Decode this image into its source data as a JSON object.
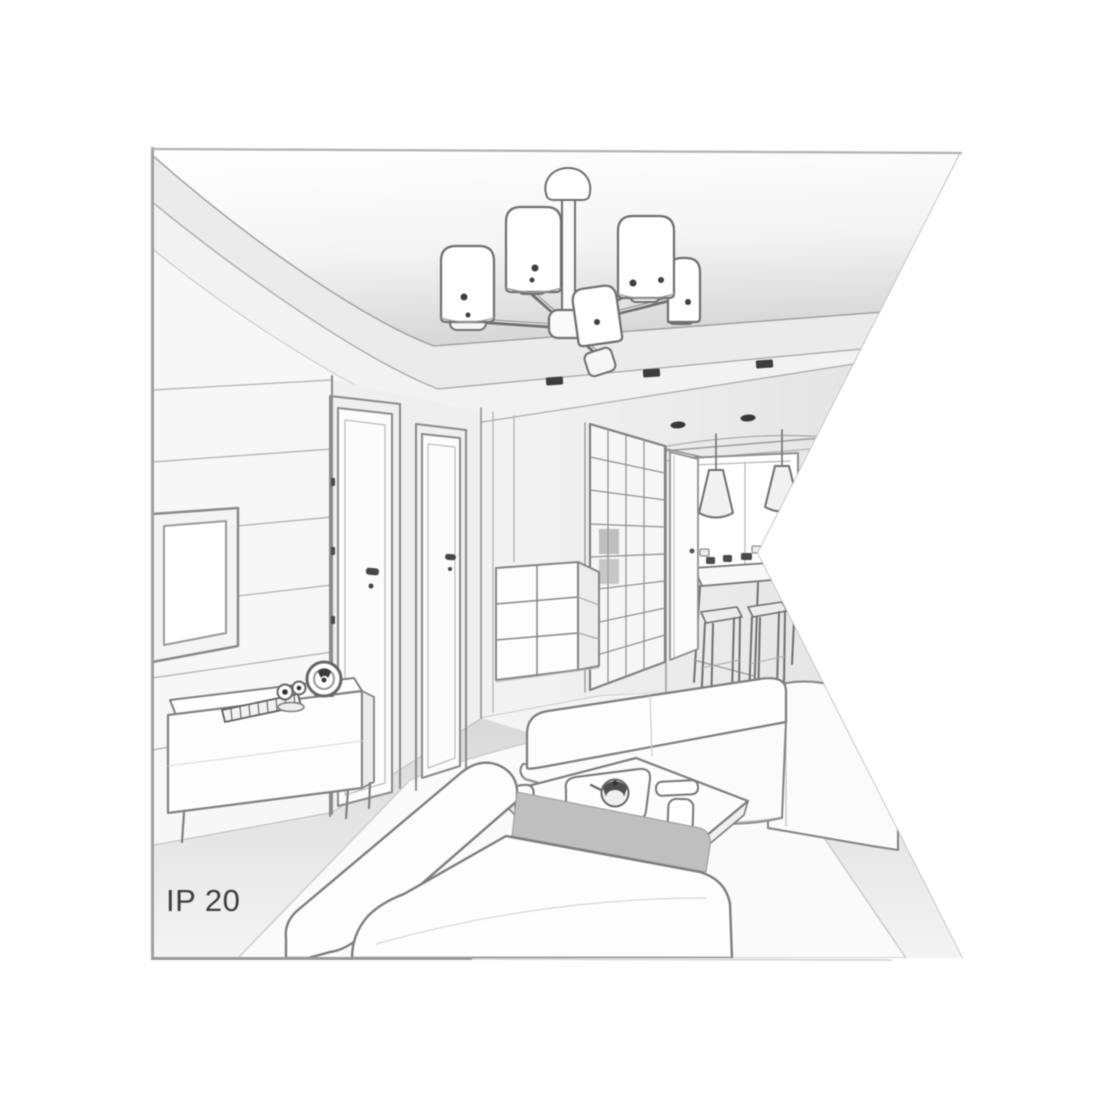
{
  "meta": {
    "description": "Grayscale line-art perspective illustration of a modern living room interior used as a lighting product scene: a multi-shade ceiling chandelier on a stepped ceiling, wall TV and sideboard, interior doors, wardrobe and hallway leading to a dining nook with cone pendant lights, sofas and a coffee table in the foreground; the right side of the drawing is cut by a white wedge. Labelled with ingress protection rating IP 20."
  },
  "label": {
    "ip_rating": "IP 20"
  },
  "palette": {
    "background": "#ffffff",
    "outline": "#7d7d7d",
    "outline_dark": "#3f3f3f",
    "fill_white": "#fdfdfd",
    "fill_light": "#f2f2f2",
    "fill_mid": "#e8e8e8",
    "fill_shadow": "#bfbfbf",
    "frame_border": "#9f9f9f",
    "label_text": "#3e3e3e"
  },
  "scene": {
    "objects": [
      "ceiling chandelier with cylindrical shades",
      "recessed ceiling spotlights",
      "wall-mounted tv frame",
      "sideboard with soundbar, clock and figurine",
      "two interior doors",
      "grid-front wardrobe",
      "chest of drawers",
      "hallway door",
      "dining table with stools",
      "two cone pendant lights",
      "window",
      "back sofa with chaise",
      "front sofa",
      "coffee table with tray, teapot, cups and remote",
      "area rug"
    ]
  }
}
